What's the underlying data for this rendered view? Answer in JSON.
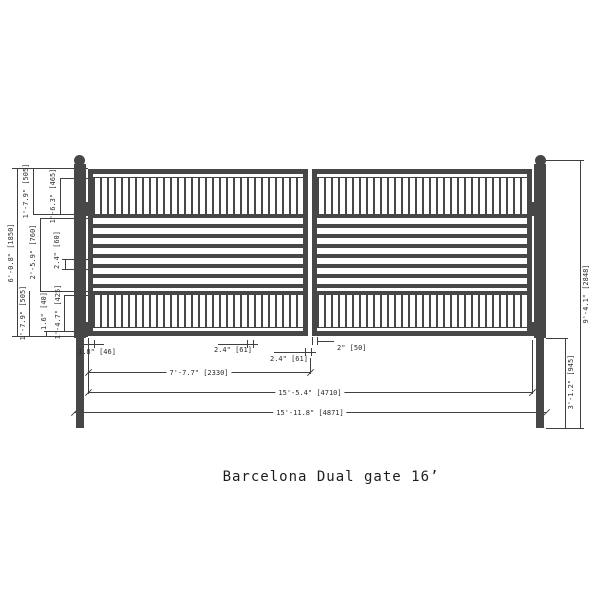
{
  "title": "Barcelona Dual gate 16’",
  "colors": {
    "line": "#3f3f3f",
    "fill": "#474747",
    "background": "#ffffff"
  },
  "dims": {
    "gate_height": "6'-0.8\" [1850]",
    "top_section": "1'-7.9\" [505]",
    "top_pickets": "1'-6.3\" [465]",
    "mid_section": "2'-5.9\" [760]",
    "bar_spacing": "2.4\" [60]",
    "bottom_section": "1'-7.9\" [505]",
    "bottom_frame": "1.6\" [40]",
    "bottom_pickets": "1'-4.7\" [425]",
    "post_height": "9'-4.1\" [2848]",
    "post_depth": "3'-1.2\" [945]",
    "hinge_gap": "1.8\" [46]",
    "picket_gap": "2.4\" [61]",
    "center_gap": "2.4\" [61]",
    "frame_width": "2\" [50]",
    "panel_width": "7'-7.7\" [2330]",
    "gates_width": "15'-5.4\" [4710]",
    "overall_width": "15'-11.8\" [4871]"
  }
}
